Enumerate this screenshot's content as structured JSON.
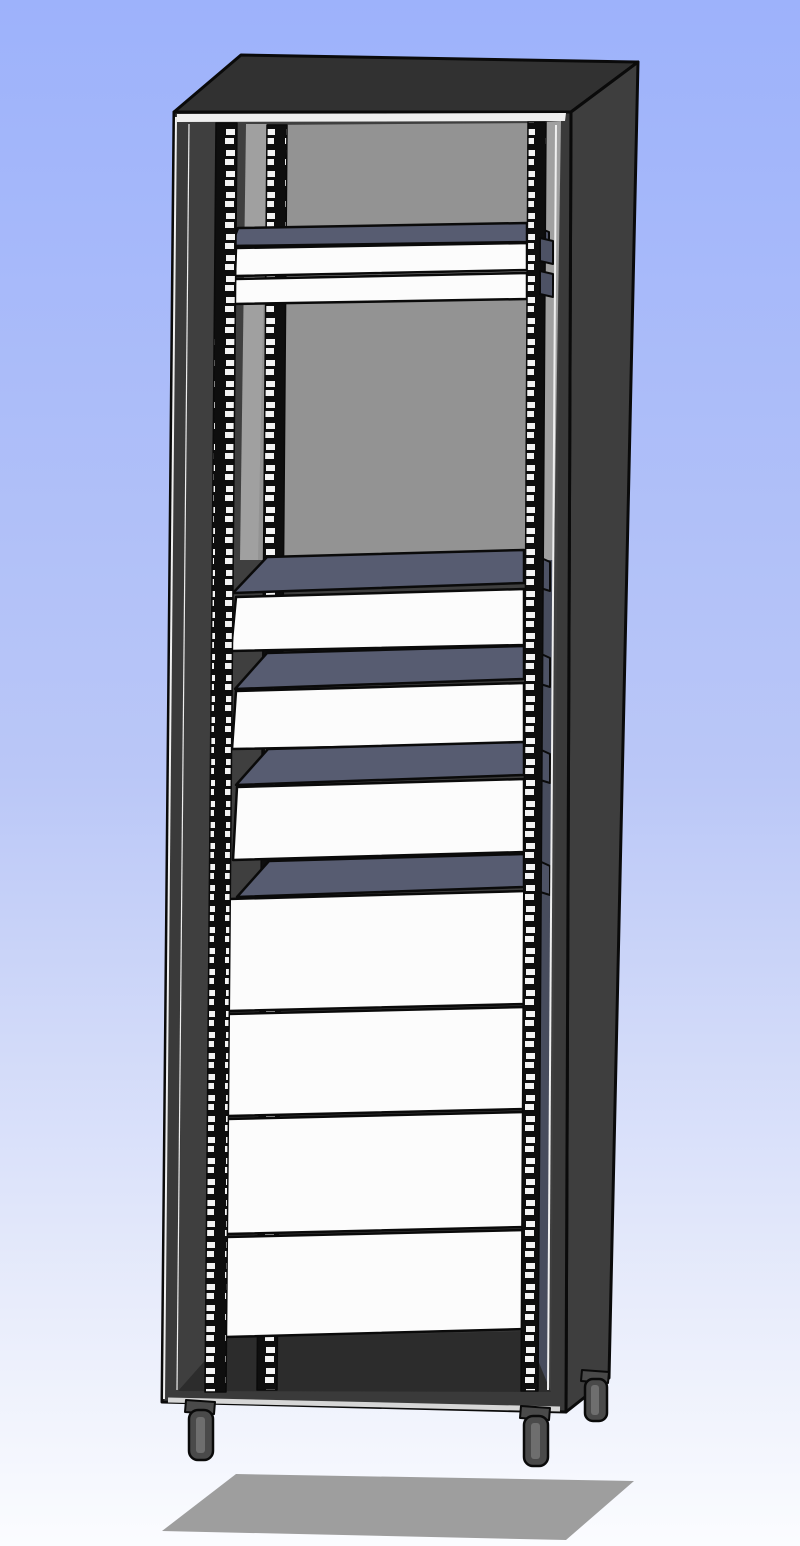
{
  "scene": {
    "description": "3D CAD render of a tall 19-inch equipment rack cabinet with perforated mounting rails, shelves, drawer fronts and blank panels, floating above a gray floor shadow on a blue gradient background",
    "component_counts": {
      "perforated_rails_visible": 3,
      "shelves": 5,
      "thin_rack_panels_top": 2,
      "drawers": 3,
      "blank_panels": 4,
      "casters_visible": 3,
      "mounting_tabs": 2
    }
  },
  "palette": {
    "bg_top": "#9db2fb",
    "bg_mid": "#bac7f7",
    "bg_low": "#e9edfb",
    "bg_bottom": "#fbfcff",
    "shadow": "#9e9e9e",
    "top_face": "#313131",
    "side_face": "#3e3e3e",
    "front_frame": "#3a3a3a",
    "inner_dark": "#3f3f3f",
    "back_panel": "#939393",
    "wall_light": "#a0a0a0",
    "right_lower": "#474c5d",
    "floor": "#2c2c2c",
    "shelf_top": "#575c71",
    "shelf_side": "#4d5265",
    "drawer_front": "#fcfcfc",
    "rail_base": "#0e0e0e",
    "rail_hole": "#f4f4f4",
    "highlight": "#efefef",
    "silver": "#d6d6d6",
    "caster": "#4a4a4a",
    "caster_hub": "#6e6e6e",
    "edge": "#0a0a0a"
  },
  "layers": [
    {
      "name": "floor-shadow",
      "type": "polygon",
      "pts": [
        [
          236,
          1474
        ],
        [
          634,
          1481
        ],
        [
          566,
          1540
        ],
        [
          162,
          1531
        ]
      ],
      "fill": "shadow"
    },
    {
      "name": "cabinet-top-face",
      "type": "polygon",
      "pts": [
        [
          174,
          112
        ],
        [
          241,
          55
        ],
        [
          638,
          62
        ],
        [
          571,
          112
        ]
      ],
      "fill": "top_face",
      "stroke": "edge",
      "sw": 3
    },
    {
      "name": "cabinet-right-face",
      "type": "polygon",
      "pts": [
        [
          571,
          112
        ],
        [
          638,
          62
        ],
        [
          609,
          1378
        ],
        [
          566,
          1412
        ]
      ],
      "fill": "side_face",
      "stroke": "edge",
      "sw": 3
    },
    {
      "name": "cabinet-front-frame",
      "type": "polygon",
      "pts": [
        [
          174,
          112
        ],
        [
          571,
          112
        ],
        [
          566,
          1412
        ],
        [
          162,
          1402
        ]
      ],
      "fill": "front_frame",
      "stroke": "edge",
      "sw": 3
    },
    {
      "name": "inner-backdrop",
      "type": "polygon",
      "pts": [
        [
          190,
          122
        ],
        [
          561,
          121
        ],
        [
          551,
          1392
        ],
        [
          178,
          1391
        ]
      ],
      "fill": "inner_dark"
    },
    {
      "name": "back-panel",
      "type": "polygon",
      "pts": [
        [
          262,
          125
        ],
        [
          546,
          123
        ],
        [
          540,
          560
        ],
        [
          255,
          560
        ]
      ],
      "fill": "back_panel"
    },
    {
      "name": "left-wall-light-strip",
      "type": "polygon",
      "pts": [
        [
          246,
          124
        ],
        [
          267,
          124
        ],
        [
          258,
          560
        ],
        [
          240,
          560
        ]
      ],
      "fill": "wall_light"
    },
    {
      "name": "right-wall-strip",
      "type": "polygon",
      "pts": [
        [
          546,
          122
        ],
        [
          561,
          121
        ],
        [
          554,
          560
        ],
        [
          540,
          560
        ]
      ],
      "fill": "wall_light"
    },
    {
      "name": "right-side-inner-lower",
      "type": "polygon",
      "pts": [
        [
          540,
          560
        ],
        [
          554,
          560
        ],
        [
          548,
          1391
        ],
        [
          536,
          1391
        ]
      ],
      "fill": "right_lower"
    },
    {
      "name": "cabinet-floor",
      "type": "polygon",
      "pts": [
        [
          178,
          1391
        ],
        [
          225,
          1338
        ],
        [
          526,
          1331
        ],
        [
          551,
          1392
        ]
      ],
      "fill": "floor"
    },
    {
      "name": "rail-rear-left",
      "type": "polygon",
      "pts": [
        [
          267,
          125
        ],
        [
          287,
          125
        ],
        [
          277,
          1390
        ],
        [
          257,
          1390
        ]
      ],
      "fill": "rail",
      "stroke": "edge",
      "sw": 1.5
    },
    {
      "name": "shelf-b",
      "type": "polygon",
      "pts": [
        [
          267,
          557
        ],
        [
          524,
          550
        ],
        [
          524,
          583
        ],
        [
          233,
          593
        ]
      ],
      "fill": "shelf_top",
      "stroke": "edge",
      "sw": 2.5
    },
    {
      "name": "shelf-b-side",
      "type": "polygon",
      "pts": [
        [
          524,
          550
        ],
        [
          550,
          562
        ],
        [
          550,
          591
        ],
        [
          524,
          583
        ]
      ],
      "fill": "shelf_side",
      "stroke": "edge",
      "sw": 2
    },
    {
      "name": "drawer-1",
      "type": "polygon",
      "pts": [
        [
          236,
          597
        ],
        [
          524,
          589
        ],
        [
          524,
          645
        ],
        [
          231,
          651
        ]
      ],
      "fill": "drawer_front",
      "stroke": "edge",
      "sw": 2.5
    },
    {
      "name": "shelf-c",
      "type": "polygon",
      "pts": [
        [
          267,
          653
        ],
        [
          524,
          646
        ],
        [
          524,
          679
        ],
        [
          235,
          689
        ]
      ],
      "fill": "shelf_top",
      "stroke": "edge",
      "sw": 2.5
    },
    {
      "name": "shelf-c-side",
      "type": "polygon",
      "pts": [
        [
          524,
          646
        ],
        [
          550,
          658
        ],
        [
          550,
          687
        ],
        [
          524,
          679
        ]
      ],
      "fill": "shelf_side",
      "stroke": "edge",
      "sw": 2
    },
    {
      "name": "drawer-2",
      "type": "polygon",
      "pts": [
        [
          236,
          691
        ],
        [
          524,
          683
        ],
        [
          524,
          744
        ],
        [
          232,
          749
        ]
      ],
      "fill": "drawer_front",
      "stroke": "edge",
      "sw": 2.5
    },
    {
      "name": "shelf-d",
      "type": "polygon",
      "pts": [
        [
          268,
          749
        ],
        [
          524,
          742
        ],
        [
          524,
          775
        ],
        [
          236,
          785
        ]
      ],
      "fill": "shelf_top",
      "stroke": "edge",
      "sw": 2.5
    },
    {
      "name": "shelf-d-side",
      "type": "polygon",
      "pts": [
        [
          524,
          742
        ],
        [
          550,
          754
        ],
        [
          550,
          783
        ],
        [
          524,
          775
        ]
      ],
      "fill": "shelf_side",
      "stroke": "edge",
      "sw": 2
    },
    {
      "name": "drawer-3",
      "type": "polygon",
      "pts": [
        [
          237,
          787
        ],
        [
          524,
          779
        ],
        [
          524,
          852
        ],
        [
          233,
          860
        ]
      ],
      "fill": "drawer_front",
      "stroke": "edge",
      "sw": 2.5
    },
    {
      "name": "shelf-e",
      "type": "polygon",
      "pts": [
        [
          269,
          861
        ],
        [
          524,
          854
        ],
        [
          524,
          887
        ],
        [
          237,
          897
        ]
      ],
      "fill": "shelf_top",
      "stroke": "edge",
      "sw": 2.5
    },
    {
      "name": "shelf-e-side",
      "type": "polygon",
      "pts": [
        [
          524,
          854
        ],
        [
          550,
          866
        ],
        [
          550,
          895
        ],
        [
          524,
          887
        ]
      ],
      "fill": "shelf_side",
      "stroke": "edge",
      "sw": 2
    },
    {
      "name": "blank-panel-1",
      "type": "polygon",
      "pts": [
        [
          229,
          899
        ],
        [
          526,
          891
        ],
        [
          526,
          1004
        ],
        [
          228,
          1011
        ]
      ],
      "fill": "drawer_front",
      "stroke": "edge",
      "sw": 2.5
    },
    {
      "name": "blank-panel-2",
      "type": "polygon",
      "pts": [
        [
          228,
          1014
        ],
        [
          526,
          1007
        ],
        [
          526,
          1109
        ],
        [
          227,
          1116
        ]
      ],
      "fill": "drawer_front",
      "stroke": "edge",
      "sw": 2.5
    },
    {
      "name": "blank-panel-3",
      "type": "polygon",
      "pts": [
        [
          227,
          1119
        ],
        [
          526,
          1112
        ],
        [
          526,
          1227
        ],
        [
          226,
          1234
        ]
      ],
      "fill": "drawer_front",
      "stroke": "edge",
      "sw": 2.5
    },
    {
      "name": "blank-panel-4",
      "type": "polygon",
      "pts": [
        [
          226,
          1237
        ],
        [
          526,
          1230
        ],
        [
          526,
          1329
        ],
        [
          225,
          1337
        ]
      ],
      "fill": "drawer_front",
      "stroke": "edge",
      "sw": 2.5
    },
    {
      "name": "shelf-a",
      "type": "polygon",
      "pts": [
        [
          238,
          228
        ],
        [
          527,
          223
        ],
        [
          527,
          242
        ],
        [
          231,
          246
        ]
      ],
      "fill": "shelf_top",
      "stroke": "edge",
      "sw": 2.5
    },
    {
      "name": "shelf-a-side",
      "type": "polygon",
      "pts": [
        [
          527,
          223
        ],
        [
          549,
          232
        ],
        [
          549,
          253
        ],
        [
          527,
          242
        ]
      ],
      "fill": "shelf_side",
      "stroke": "edge",
      "sw": 2
    },
    {
      "name": "rack-unit-panel-1",
      "type": "polygon",
      "pts": [
        [
          236,
          248
        ],
        [
          527,
          243
        ],
        [
          527,
          270
        ],
        [
          235,
          276
        ]
      ],
      "fill": "drawer_front",
      "stroke": "edge",
      "sw": 2.5
    },
    {
      "name": "rack-unit-panel-2",
      "type": "polygon",
      "pts": [
        [
          235,
          279
        ],
        [
          527,
          273
        ],
        [
          527,
          299
        ],
        [
          234,
          304
        ]
      ],
      "fill": "drawer_front",
      "stroke": "edge",
      "sw": 2.5
    },
    {
      "name": "rail-front-left",
      "type": "polygon",
      "pts": [
        [
          216,
          123
        ],
        [
          237,
          123
        ],
        [
          226,
          1392
        ],
        [
          205,
          1392
        ]
      ],
      "fill": "rail",
      "stroke": "edge",
      "sw": 1.5
    },
    {
      "name": "rail-right",
      "type": "polygon",
      "pts": [
        [
          528,
          122
        ],
        [
          546,
          122
        ],
        [
          538,
          1391
        ],
        [
          521,
          1391
        ]
      ],
      "fill": "rail",
      "stroke": "edge",
      "sw": 1.5
    },
    {
      "name": "mounting-tab-1",
      "type": "polygon",
      "pts": [
        [
          540,
          238
        ],
        [
          553,
          241
        ],
        [
          553,
          264
        ],
        [
          540,
          261
        ]
      ],
      "fill": "shelf_side",
      "stroke": "edge",
      "sw": 2
    },
    {
      "name": "mounting-tab-2",
      "type": "polygon",
      "pts": [
        [
          540,
          271
        ],
        [
          553,
          274
        ],
        [
          553,
          297
        ],
        [
          540,
          294
        ]
      ],
      "fill": "shelf_side",
      "stroke": "edge",
      "sw": 2
    },
    {
      "name": "right-corner-highlight",
      "type": "line",
      "x1": 556,
      "y1": 125,
      "x2": 548,
      "y2": 1390,
      "stroke": "highlight",
      "sw": 2
    },
    {
      "name": "top-edge-highlight",
      "type": "polygon",
      "pts": [
        [
          177,
          114
        ],
        [
          566,
          113
        ],
        [
          565,
          121
        ],
        [
          177,
          122
        ]
      ],
      "fill": "highlight"
    },
    {
      "name": "left-outer-highlight",
      "type": "line",
      "x1": 176,
      "y1": 117,
      "x2": 164,
      "y2": 1399,
      "stroke": "highlight",
      "sw": 2
    },
    {
      "name": "left-inner-highlight",
      "type": "line",
      "x1": 189,
      "y1": 124,
      "x2": 177,
      "y2": 1390,
      "stroke": "highlight",
      "sw": 1.2
    },
    {
      "name": "bottom-edge-highlight",
      "type": "line",
      "x1": 168,
      "y1": 1400,
      "x2": 560,
      "y2": 1409,
      "stroke": "silver",
      "sw": 5
    },
    {
      "name": "caster-front-left-plate",
      "type": "polygon",
      "pts": [
        [
          186,
          1400
        ],
        [
          215,
          1402
        ],
        [
          214,
          1414
        ],
        [
          185,
          1412
        ]
      ],
      "fill": "caster",
      "stroke": "edge",
      "sw": 2
    },
    {
      "name": "caster-front-left-wheel",
      "type": "rect",
      "x": 189,
      "y": 1410,
      "w": 24,
      "h": 50,
      "rx": 9,
      "fill": "caster",
      "stroke": "edge",
      "sw": 2.5
    },
    {
      "name": "caster-front-left-hub",
      "type": "rect",
      "x": 196,
      "y": 1417,
      "w": 9,
      "h": 36,
      "rx": 3,
      "fill": "caster_hub"
    },
    {
      "name": "caster-front-right-plate",
      "type": "polygon",
      "pts": [
        [
          521,
          1406
        ],
        [
          550,
          1408
        ],
        [
          549,
          1420
        ],
        [
          520,
          1418
        ]
      ],
      "fill": "caster",
      "stroke": "edge",
      "sw": 2
    },
    {
      "name": "caster-front-right-wheel",
      "type": "rect",
      "x": 524,
      "y": 1416,
      "w": 24,
      "h": 50,
      "rx": 9,
      "fill": "caster",
      "stroke": "edge",
      "sw": 2.5
    },
    {
      "name": "caster-front-right-hub",
      "type": "rect",
      "x": 531,
      "y": 1423,
      "w": 9,
      "h": 36,
      "rx": 3,
      "fill": "caster_hub"
    },
    {
      "name": "caster-rear-right-plate",
      "type": "polygon",
      "pts": [
        [
          582,
          1370
        ],
        [
          609,
          1372
        ],
        [
          608,
          1383
        ],
        [
          581,
          1381
        ]
      ],
      "fill": "caster",
      "stroke": "edge",
      "sw": 2
    },
    {
      "name": "caster-rear-right-wheel",
      "type": "rect",
      "x": 585,
      "y": 1379,
      "w": 22,
      "h": 42,
      "rx": 8,
      "fill": "caster",
      "stroke": "edge",
      "sw": 2.5
    },
    {
      "name": "caster-rear-right-hub",
      "type": "rect",
      "x": 591,
      "y": 1385,
      "w": 8,
      "h": 30,
      "rx": 3,
      "fill": "caster_hub"
    }
  ]
}
